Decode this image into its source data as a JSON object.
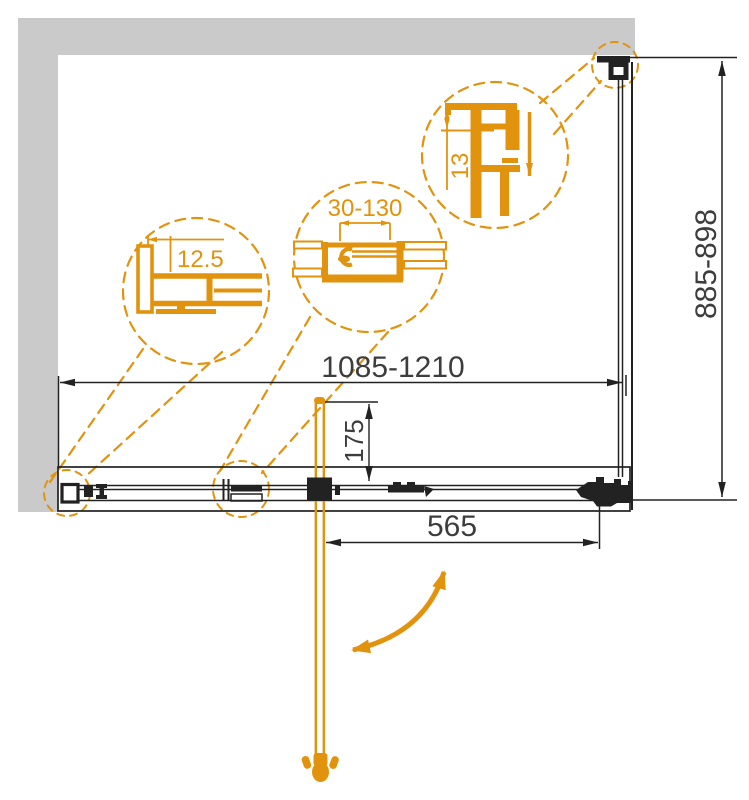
{
  "colors": {
    "accent": "#E2930D",
    "wall": "#CACACA",
    "line": "#222222",
    "dim": "#3D3D3D"
  },
  "dimensions": {
    "overall_width": "1085-1210",
    "overall_height": "885-898",
    "door_width": "565",
    "handle_offset": "175",
    "detail_left": "12.5",
    "detail_middle": "30-130",
    "detail_right": "13"
  }
}
